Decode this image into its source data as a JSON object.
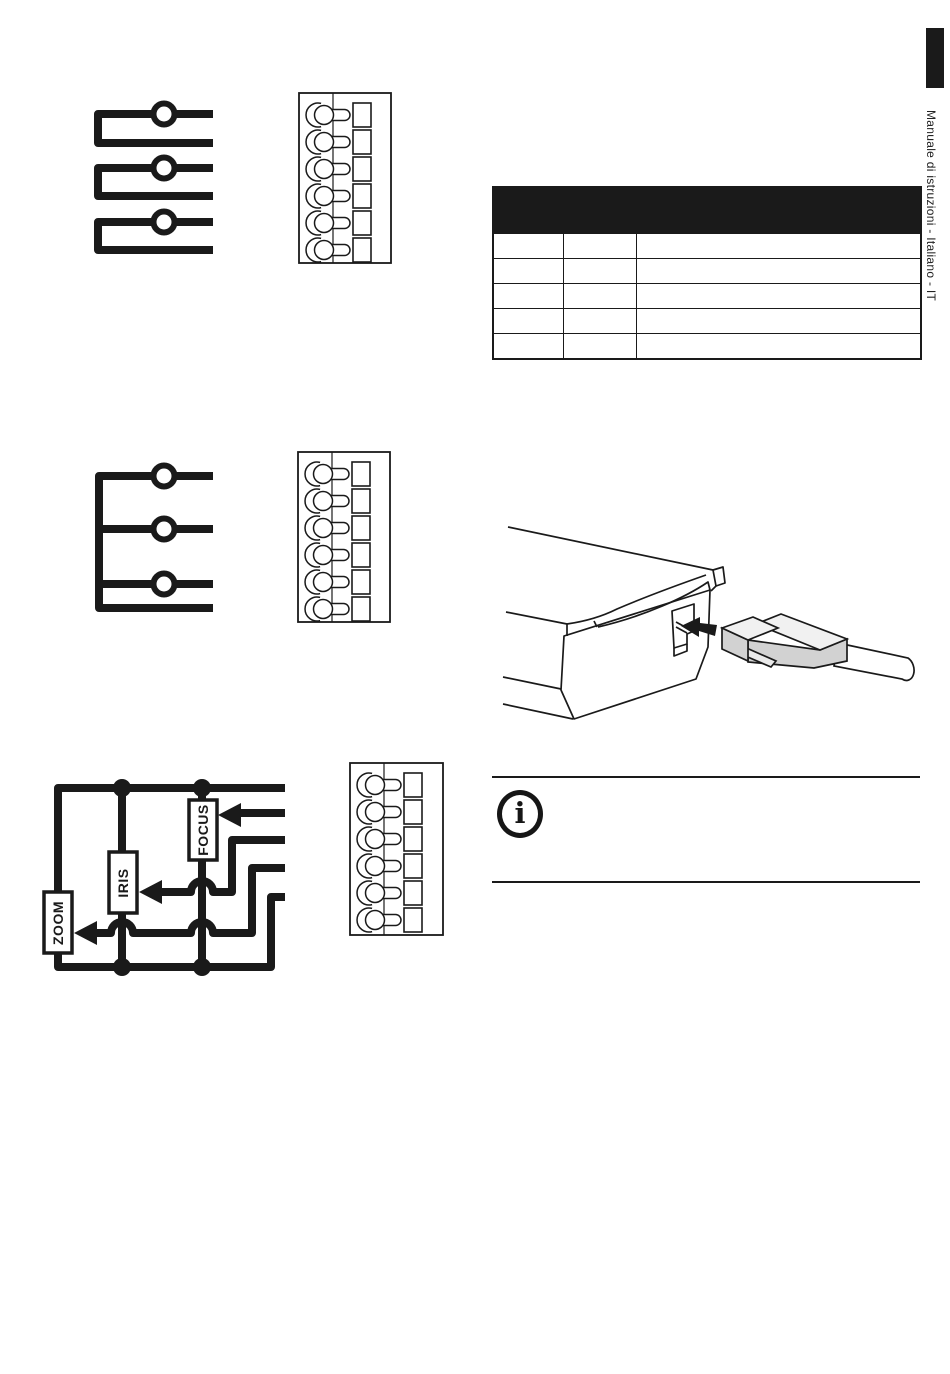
{
  "page": {
    "type": "instruction-manual-page",
    "background": "#ffffff",
    "ink_color": "#1a1a1a"
  },
  "sidebar": {
    "vertical_text": "Manuale di istruzioni - Italiano - IT",
    "tab_color": "#1a1a1a"
  },
  "pin_table": {
    "header_label": "",
    "header_bg": "#1a1a1a",
    "columns": [
      "",
      "",
      ""
    ],
    "rows": [
      [
        "",
        "",
        ""
      ],
      [
        "",
        "",
        ""
      ],
      [
        "",
        "",
        ""
      ],
      [
        "",
        "",
        ""
      ],
      [
        "",
        "",
        ""
      ]
    ]
  },
  "schematic": {
    "labels": {
      "zoom": "ZOOM",
      "iris": "IRIS",
      "focus": "FOCUS"
    }
  },
  "info_note": {
    "icon": "i"
  },
  "terminal_blocks": {
    "count": 3,
    "positions_per_block": 6
  },
  "connector_illustration": {
    "plug_body_color": "#d2d2d2",
    "plug_top_color": "#f1f1f1",
    "latch_color": "#e9e9e9",
    "cable_color": "#ffffff"
  }
}
